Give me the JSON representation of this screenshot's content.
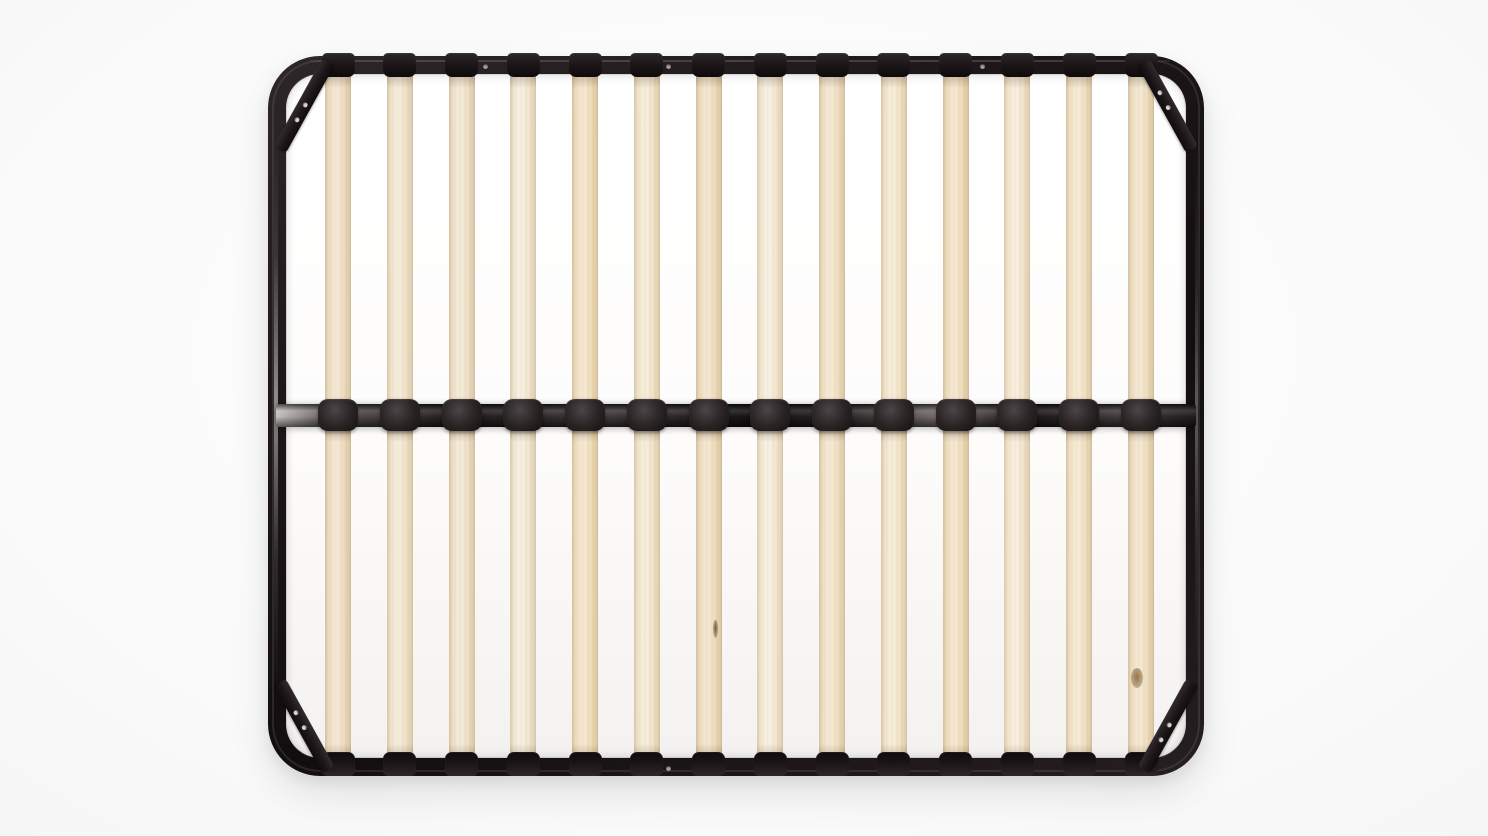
{
  "image": {
    "type": "product-photo",
    "subject": "Black metal platform bed frame base with natural wood slats, viewed from directly above",
    "background_color": "#f7f7f8"
  },
  "frame": {
    "finish": "glossy black steel",
    "finish_color": "#1d1719",
    "sheen_color": "#c4c0bd",
    "corner_bracket_count": 4,
    "bracket_holes_per_corner": 2,
    "rivet_top_x": [
      485,
      668,
      982
    ],
    "rivet_bottom_x": [
      668
    ]
  },
  "center_rail": {
    "cap_color": "#2a2425",
    "cap_count": 14
  },
  "slats": {
    "halves": 2,
    "count_per_half": 14,
    "wood": "birch",
    "base_color": "#f0e1c4",
    "tones": [
      "#eedcbf",
      "#f1e3c9",
      "#efe0c6",
      "#f3e7d1",
      "#f0ddba",
      "#f2e4c8",
      "#eedbbb",
      "#f4e8d2",
      "#f0dfc0",
      "#f2e3c6",
      "#efdcba",
      "#f3e6cd",
      "#f1e0c1",
      "#eeddbe"
    ]
  },
  "knots": [
    {
      "slat_index": 6,
      "half": "bottom",
      "x_offset": 7,
      "y": 620,
      "width": 5,
      "height": 18,
      "color": "#6f5f40"
    },
    {
      "slat_index": 13,
      "half": "bottom",
      "x_offset": -4,
      "y": 668,
      "width": 12,
      "height": 20,
      "color": "#9a7344"
    }
  ]
}
